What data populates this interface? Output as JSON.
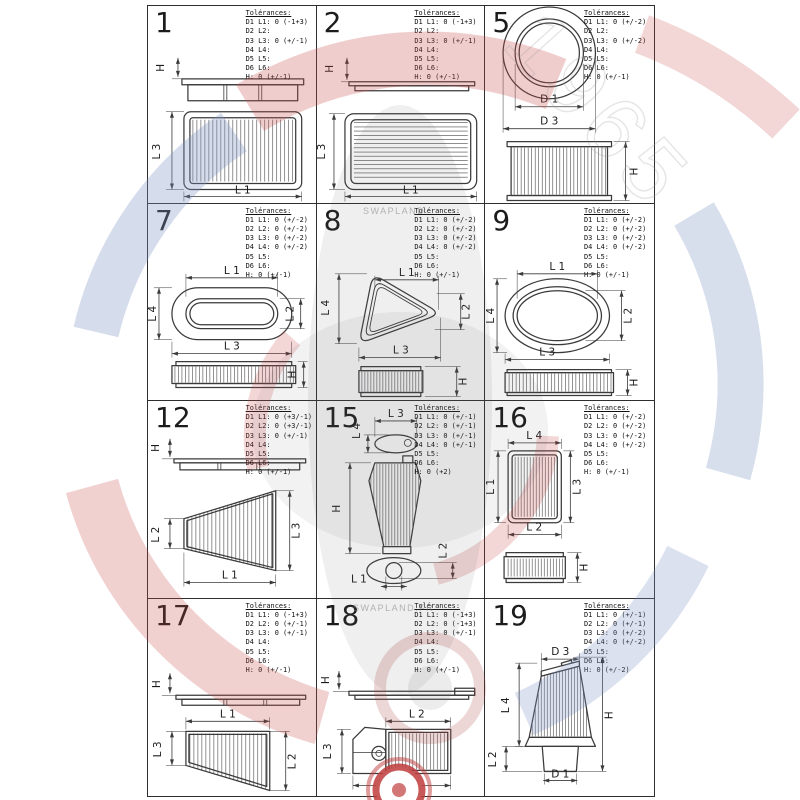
{
  "labels": {
    "tolerances_title": "Tolérances:"
  },
  "watermark": {
    "brand_top": "SWAPLAND",
    "brand_bottom": "SWAPLAND.FR",
    "year": "1965",
    "red": "#c94a4a",
    "blue": "#7c94c4"
  },
  "cells": [
    {
      "number": "1",
      "tolerances": [
        "D1 L1: 0 (-1+3)",
        "D2 L2:",
        "D3 L3: 0 (+/-1)",
        "D4 L4:",
        "D5 L5:",
        "D6 L6:",
        "H: 0 (+/-1)"
      ],
      "dims": [
        "H",
        "L 3",
        "L 1"
      ]
    },
    {
      "number": "2",
      "tolerances": [
        "D1 L1: 0 (-1+3)",
        "D2 L2:",
        "D3 L3: 0 (+/-1)",
        "D4 L4:",
        "D5 L5:",
        "D6 L6:",
        "H: 0 (+/-1)"
      ],
      "dims": [
        "H",
        "L 3",
        "L 1"
      ]
    },
    {
      "number": "5",
      "tolerances": [
        "D1 L1: 0 (+/-2)",
        "D2 L2:",
        "D3 L3: 0 (+/-2)",
        "D4 L4:",
        "D5 L5:",
        "D6 L6:",
        "H: 0 (+/-1)"
      ],
      "dims": [
        "D 1",
        "D 3",
        "H"
      ]
    },
    {
      "number": "7",
      "tolerances": [
        "D1 L1: 0 (+/-2)",
        "D2 L2: 0 (+/-2)",
        "D3 L3: 0 (+/-2)",
        "D4 L4: 0 (+/-2)",
        "D5 L5:",
        "D6 L6:",
        "H: 0 (+/-1)"
      ],
      "dims": [
        "L 1",
        "L 4",
        "L 3",
        "L 2",
        "H"
      ]
    },
    {
      "number": "8",
      "tolerances": [
        "D1 L1: 0 (+/-2)",
        "D2 L2: 0 (+/-2)",
        "D3 L3: 0 (+/-2)",
        "D4 L4: 0 (+/-2)",
        "D5 L5:",
        "D6 L6:",
        "H: 0 (+/-1)"
      ],
      "dims": [
        "L 1",
        "L 4",
        "L 2",
        "L 3",
        "H"
      ]
    },
    {
      "number": "9",
      "tolerances": [
        "D1 L1: 0 (+/-2)",
        "D2 L2: 0 (+/-2)",
        "D3 L3: 0 (+/-2)",
        "D4 L4: 0 (+/-2)",
        "D5 L5:",
        "D6 L6:",
        "H: 0 (+/-1)"
      ],
      "dims": [
        "L 1",
        "L 4",
        "L 2",
        "L 3",
        "H"
      ]
    },
    {
      "number": "12",
      "tolerances": [
        "D1 L1: 0 (+3/-1)",
        "D2 L2: 0 (+3/-1)",
        "D3 L3: 0 (+/-1)",
        "D4 L4:",
        "D5 L5:",
        "D6 L6:",
        "H: 0 (+/-1)"
      ],
      "dims": [
        "H",
        "L 2",
        "L 3",
        "L 1"
      ]
    },
    {
      "number": "15",
      "tolerances": [
        "D1 L1: 0 (+/-1)",
        "D2 L2: 0 (+/-1)",
        "D3 L3: 0 (+/-1)",
        "D4 L4: 0 (+/-1)",
        "D5 L5:",
        "D6 L6:",
        "H: 0 (+2)"
      ],
      "dims": [
        "L 3",
        "L 4",
        "H",
        "L 1",
        "L 2"
      ]
    },
    {
      "number": "16",
      "tolerances": [
        "D1 L1: 0 (+/-2)",
        "D2 L2: 0 (+/-2)",
        "D3 L3: 0 (+/-2)",
        "D4 L4: 0 (+/-2)",
        "D5 L5:",
        "D6 L6:",
        "H: 0 (+/-1)"
      ],
      "dims": [
        "L 4",
        "L 1",
        "L 3",
        "L 2",
        "H"
      ]
    },
    {
      "number": "17",
      "tolerances": [
        "D1 L1: 0 (-1+3)",
        "D2 L2: 0 (+/-1)",
        "D3 L3: 0 (+/-1)",
        "D4 L4:",
        "D5 L5:",
        "D6 L6:",
        "H: 0 (+/-1)"
      ],
      "dims": [
        "H",
        "L 1",
        "L 3",
        "L 2"
      ]
    },
    {
      "number": "18",
      "tolerances": [
        "D1 L1: 0 (-1+3)",
        "D2 L2: 0 (-1+3)",
        "D3 L3: 0 (+/-1)",
        "D4 L4:",
        "D5 L5:",
        "D6 L6:",
        "H: 0 (+/-1)"
      ],
      "dims": [
        "H",
        "L 2",
        "L 3",
        "L 1"
      ]
    },
    {
      "number": "19",
      "tolerances": [
        "D1 L1: 0 (+/-1)",
        "D2 L2: 0 (+/-1)",
        "D3 L3: 0 (+/-2)",
        "D4 L4: 0 (+/-2)",
        "D5 L5:",
        "D6 L6:",
        "H: 0 (+/-2)"
      ],
      "dims": [
        "D 3",
        "L 4",
        "H",
        "L 2",
        "D 1"
      ]
    }
  ]
}
